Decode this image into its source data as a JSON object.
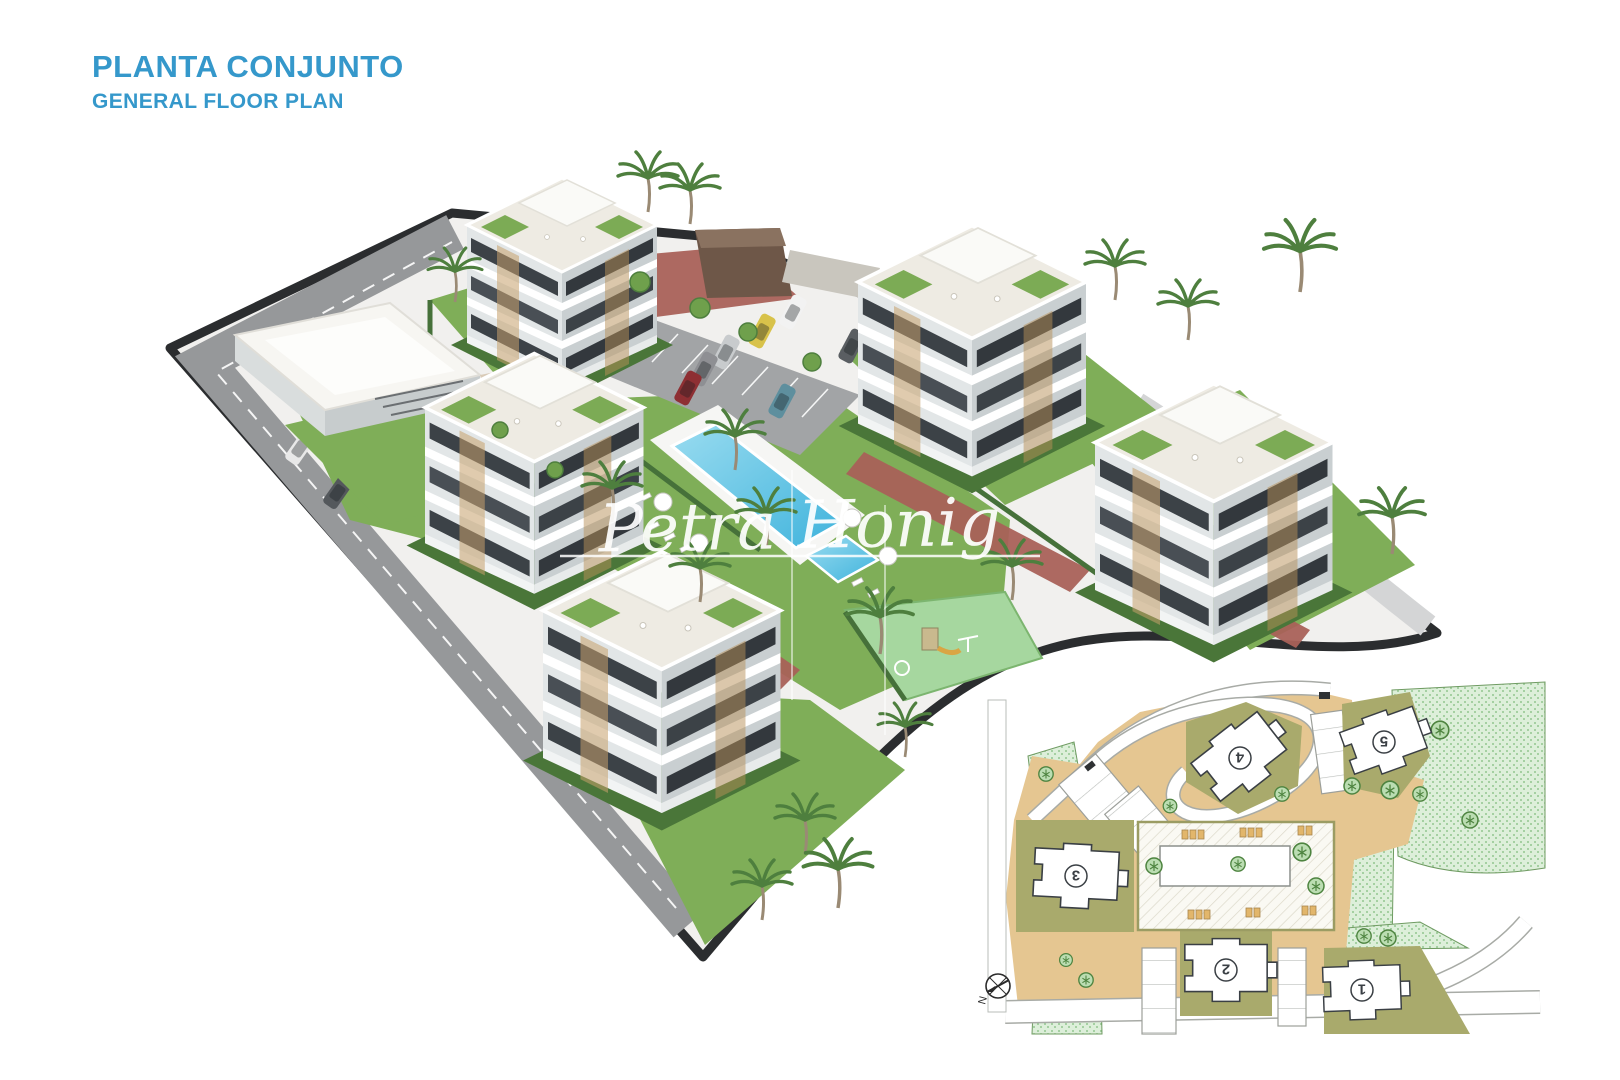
{
  "header": {
    "title": "PLANTA CONJUNTO",
    "subtitle": "GENERAL FLOOR PLAN"
  },
  "watermark": {
    "text": "Petra Honig"
  },
  "colors": {
    "accent_blue": "#3598CB",
    "pool_water": "#55C2E4",
    "pool_water_light": "#9ADCF0",
    "lawn_green": "#7FAE58",
    "hedge_green": "#4A7639",
    "playground_green": "#A6D79F",
    "brick_path_red": "#A96158",
    "perimeter_road_gray": "#96989A",
    "site_wall_dark": "#2B2D2F",
    "building_facade_light": "#E2E6E7",
    "building_facade_shade": "#C9CFD1",
    "window_dark": "#3C4247",
    "plan_road_tan": "#E5C691",
    "plan_building_zone_olive": "#A9AA6C",
    "plan_landscape_green": "#DDEFDA",
    "plan_tree_green": "#BBDDB2"
  },
  "site_plan": {
    "buildings": [
      {
        "number": "1"
      },
      {
        "number": "2"
      },
      {
        "number": "3"
      },
      {
        "number": "4"
      },
      {
        "number": "5"
      }
    ],
    "compass_label": "N"
  }
}
